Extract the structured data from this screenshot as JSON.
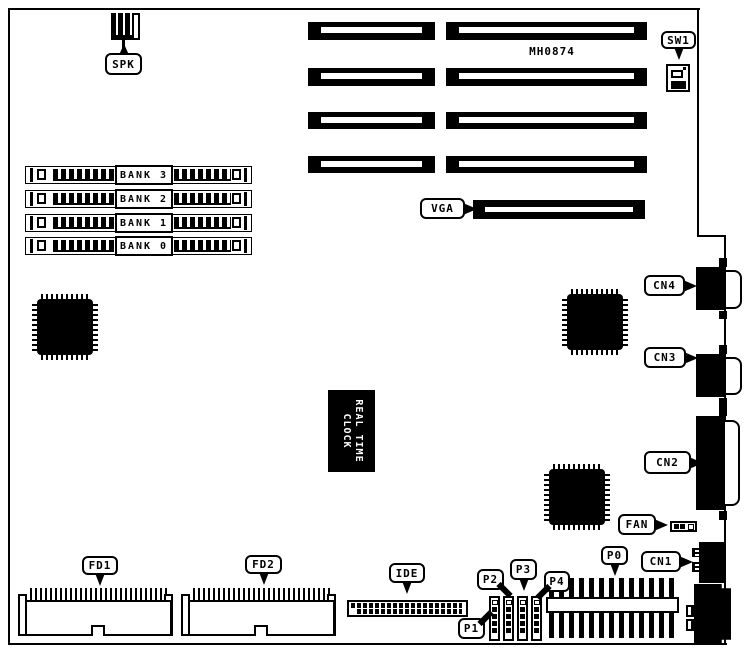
{
  "diagram": {
    "board_id": "MH0874",
    "colors": {
      "ink": "#000000",
      "paper": "#ffffff"
    },
    "callouts": {
      "spk": "SPK",
      "sw1": "SW1",
      "vga": "VGA",
      "cn4": "CN4",
      "cn3": "CN3",
      "cn2": "CN2",
      "cn1": "CN1",
      "fan": "FAN",
      "fd1": "FD1",
      "fd2": "FD2",
      "ide": "IDE",
      "p0": "P0",
      "p1": "P1",
      "p2": "P2",
      "p3": "P3",
      "p4": "P4"
    },
    "memory_banks": [
      {
        "label": "BANK 3"
      },
      {
        "label": "BANK 2"
      },
      {
        "label": "BANK 1"
      },
      {
        "label": "BANK 0"
      }
    ],
    "rtc": {
      "line1": "REAL TIME",
      "line2": "CLOCK"
    }
  }
}
